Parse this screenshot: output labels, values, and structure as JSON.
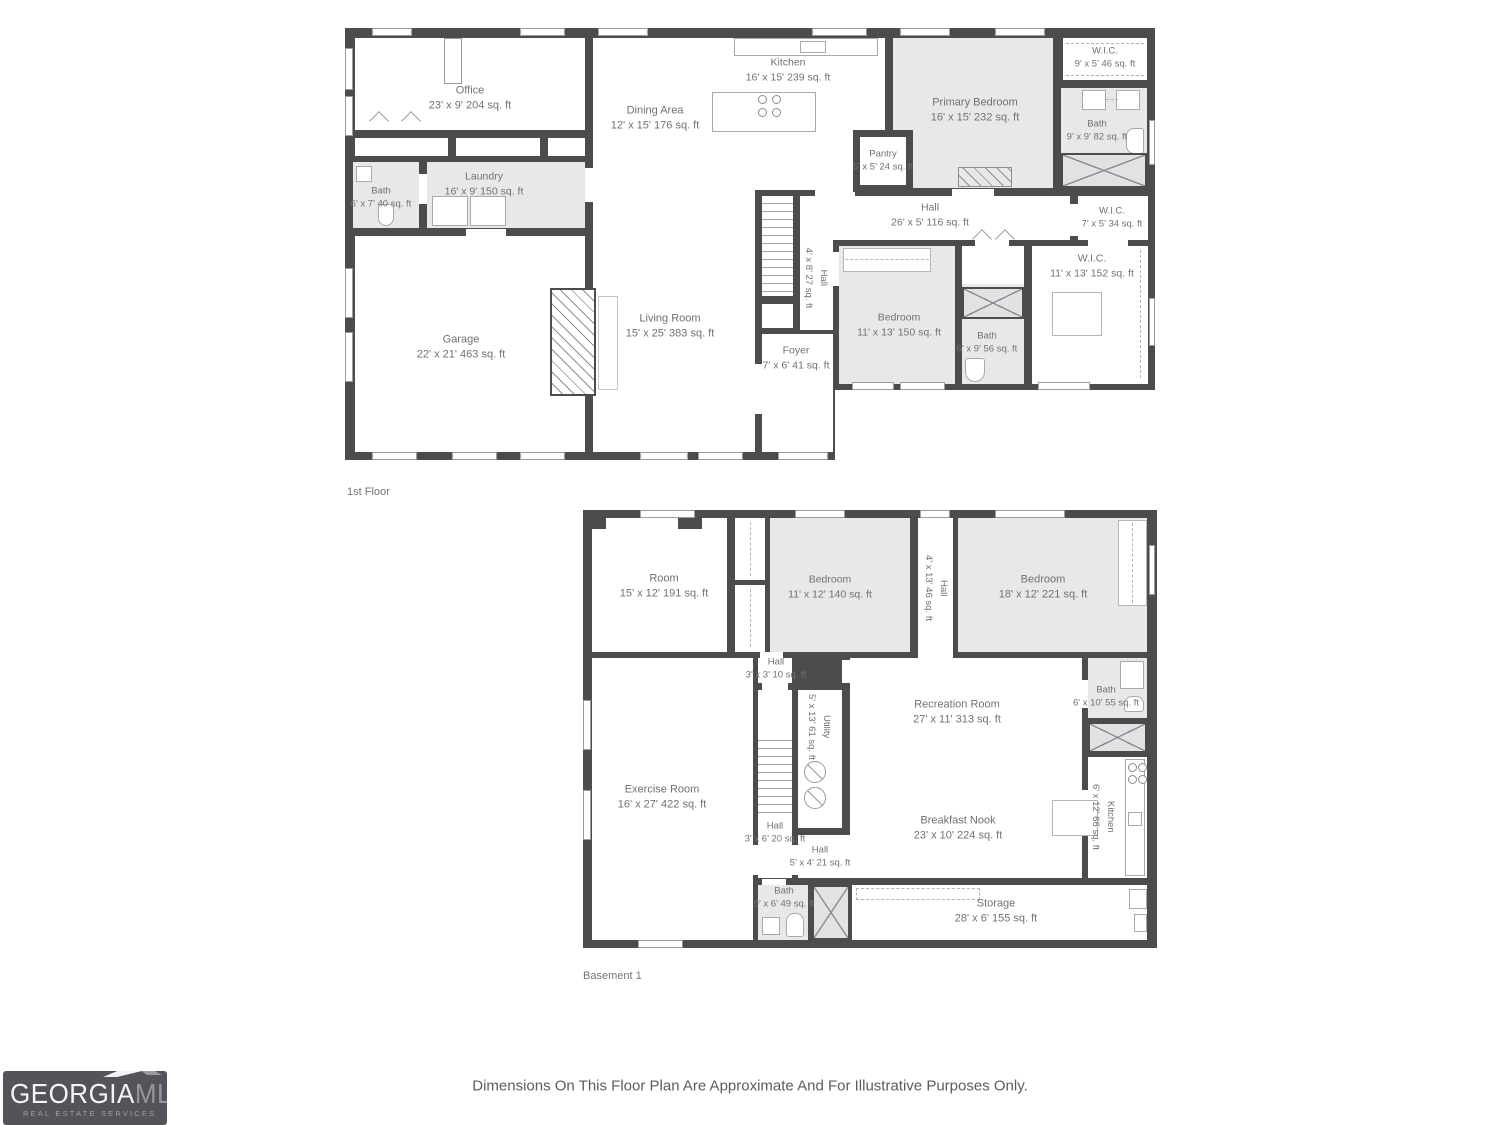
{
  "floor1": {
    "label": "1st Floor",
    "rooms": {
      "office": {
        "name": "Office",
        "dims": "23' x 9' 204 sq. ft"
      },
      "kitchen": {
        "name": "Kitchen",
        "dims": "16' x 15' 239 sq. ft"
      },
      "dining": {
        "name": "Dining Area",
        "dims": "12' x 15' 176 sq. ft"
      },
      "primary_bedroom": {
        "name": "Primary Bedroom",
        "dims": "16' x 15' 232 sq. ft"
      },
      "wic_top": {
        "name": "W.I.C.",
        "dims": "9' x 5' 46 sq. ft"
      },
      "bath_primary": {
        "name": "Bath",
        "dims": "9' x 9' 82 sq. ft"
      },
      "pantry": {
        "name": "Pantry",
        "dims": "5' x 5' 24 sq. ft"
      },
      "laundry": {
        "name": "Laundry",
        "dims": "16' x 9' 150 sq. ft"
      },
      "bath_left": {
        "name": "Bath",
        "dims": "6' x 7' 40 sq. ft"
      },
      "hall_main": {
        "name": "Hall",
        "dims": "26' x 5' 116 sq. ft"
      },
      "wic_small": {
        "name": "W.I.C.",
        "dims": "7' x 5' 34 sq. ft"
      },
      "wic_large": {
        "name": "W.I.C.",
        "dims": "11' x 13' 152 sq. ft"
      },
      "garage": {
        "name": "Garage",
        "dims": "22' x 21' 463 sq. ft"
      },
      "living": {
        "name": "Living Room",
        "dims": "15' x 25' 383 sq. ft"
      },
      "foyer": {
        "name": "Foyer",
        "dims": "7' x 6' 41 sq. ft"
      },
      "hall_stairs": {
        "name": "Hall",
        "dims": "4' x 8' 27 sq. ft"
      },
      "bedroom": {
        "name": "Bedroom",
        "dims": "11' x 13' 150 sq. ft"
      },
      "bath_mid": {
        "name": "Bath",
        "dims": "6' x 9' 56 sq. ft"
      }
    }
  },
  "basement": {
    "label": "Basement 1",
    "rooms": {
      "room": {
        "name": "Room",
        "dims": "15' x 12' 191 sq. ft"
      },
      "bedroom_a": {
        "name": "Bedroom",
        "dims": "11' x 12' 140 sq. ft"
      },
      "hall_vertical": {
        "name": "Hall",
        "dims": "4' x 13' 46 sq. ft"
      },
      "bedroom_b": {
        "name": "Bedroom",
        "dims": "18' x 12' 221 sq. ft"
      },
      "hall_top": {
        "name": "Hall",
        "dims": "3' x 3' 10 sq. ft"
      },
      "utility": {
        "name": "Utility",
        "dims": "5' x 13' 61 sq. ft"
      },
      "recreation": {
        "name": "Recreation Room",
        "dims": "27' x 11' 313 sq. ft"
      },
      "bath_upper": {
        "name": "Bath",
        "dims": "6' x 10' 55 sq. ft"
      },
      "exercise": {
        "name": "Exercise Room",
        "dims": "16' x 27' 422 sq. ft"
      },
      "hall_mid": {
        "name": "Hall",
        "dims": "3' x 6' 20 sq. ft"
      },
      "hall_lower": {
        "name": "Hall",
        "dims": "5' x 4' 21 sq. ft"
      },
      "breakfast": {
        "name": "Breakfast Nook",
        "dims": "23' x 10' 224 sq. ft"
      },
      "kitchen": {
        "name": "Kitchen",
        "dims": "6' x 12' 66 sq. ft"
      },
      "bath_lower": {
        "name": "Bath",
        "dims": "9' x 6' 49 sq. ft"
      },
      "storage": {
        "name": "Storage",
        "dims": "28' x 6' 155 sq. ft"
      }
    }
  },
  "footer": {
    "disclaimer": "Dimensions On This Floor Plan Are Approximate And For Illustrative Purposes Only."
  },
  "logo": {
    "brand_primary": "GEORGIA",
    "brand_secondary": "MLS",
    "tagline": "REAL ESTATE SERVICES"
  },
  "colors": {
    "wall": "#4c4c4e",
    "room_shaded": "#e8e8e9",
    "label_text": "#707177",
    "logo_bg": "#55535a"
  }
}
